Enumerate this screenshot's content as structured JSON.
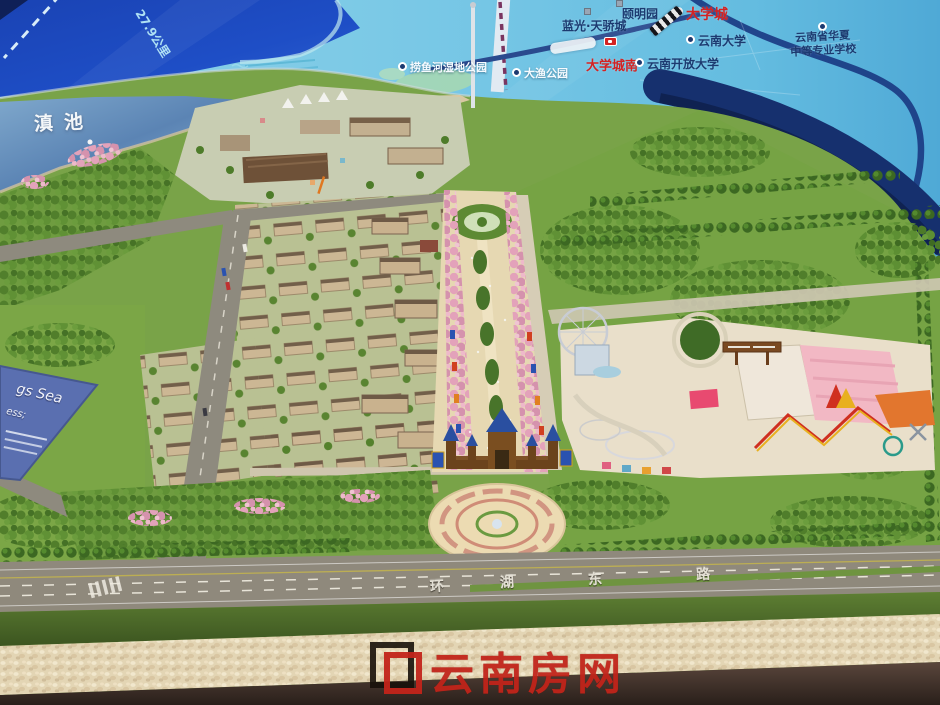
{
  "screen_map": {
    "distance_label": "27.9公里",
    "labels": {
      "wetland_park": "捞鱼河湿地公园",
      "dayu_park": "大渔公园",
      "blueray_city": "蓝光·天骄城",
      "yiming_garden": "颐明园",
      "university_town": "大学城",
      "university_town_south": "大学城南",
      "yunnan_university": "云南大学",
      "yunnan_open_university": "云南开放大学",
      "huaxia_school_line1": "云南省华夏",
      "huaxia_school_line2": "中等专业学校"
    }
  },
  "model": {
    "lake_label": "滇池",
    "road_name_chars": [
      "环",
      "湖",
      "东",
      "路"
    ],
    "plaque": {
      "line1": "gs Sea",
      "line2": "ess;"
    }
  },
  "watermark": {
    "text": "云南房网"
  },
  "colors": {
    "screen_deep_blue": "#1e4ec6",
    "screen_map_cyan": "#74c6e4",
    "map_label_navy": "#1c3a70",
    "map_label_red": "#d42222",
    "watermark_red": "#c2241a",
    "blossom_pink": "#e8a8bd",
    "park_green": "#6d9a3f",
    "road_gray": "#8e8a7e",
    "plaza_beige": "#ecdbb2",
    "table_brown": "#43352c"
  }
}
